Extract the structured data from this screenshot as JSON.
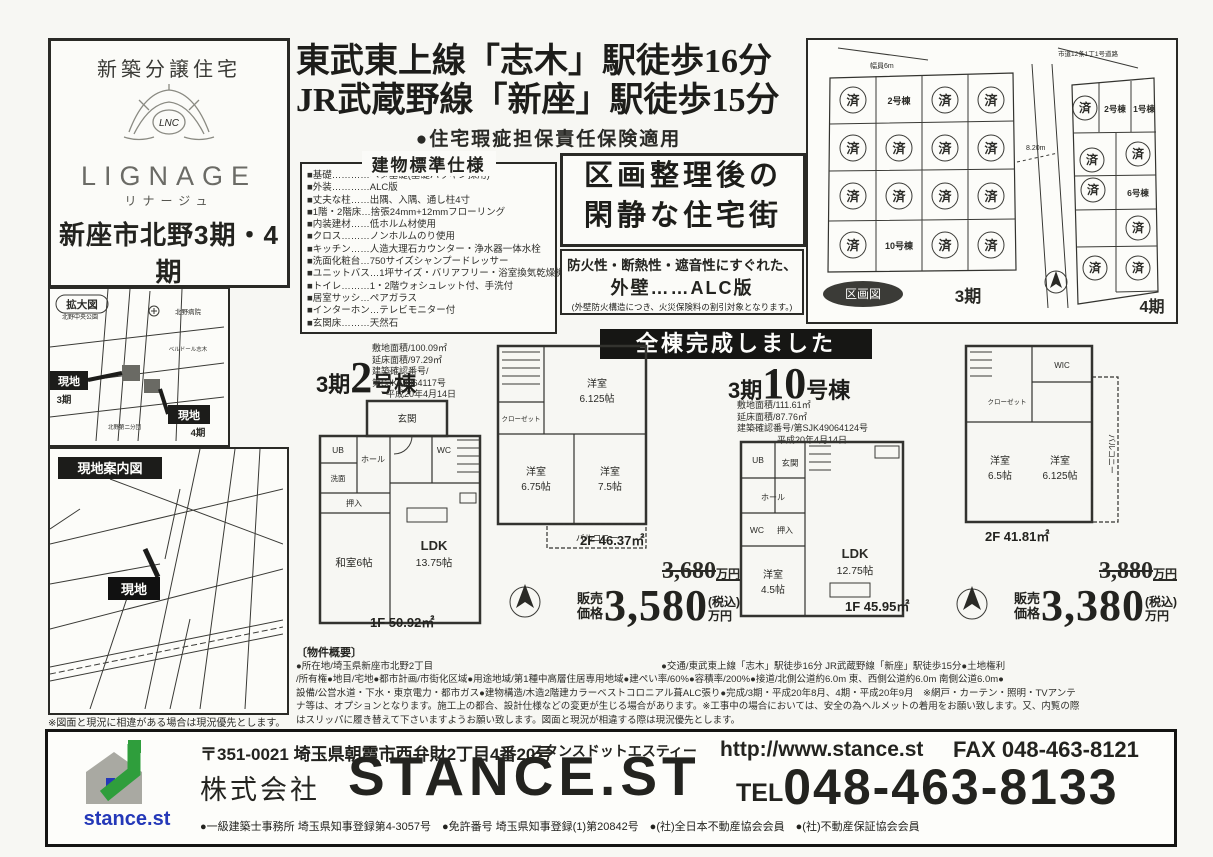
{
  "brand": {
    "tagline": "新築分譲住宅",
    "name": "LIGNAGE",
    "kana": "リナージュ",
    "project": "新座市北野3期・4期",
    "total_units": "全24棟"
  },
  "headline": {
    "line1": "東武東上線「志木」駅徒歩16分",
    "line2": "JR武蔵野線「新座」駅徒歩15分",
    "insurance": "●住宅瑕疵担保責任保険適用"
  },
  "specs": {
    "title": "建物標準仕様",
    "items": [
      "■基礎…………ベタ基礎(基礎パッキン採用)",
      "■外装…………ALC版",
      "■丈夫な柱……出隅、入隅、通し柱4寸",
      "■1階・2階床…捨張24mm+12mmフローリング",
      "■内装建材……低ホルム材使用",
      "■クロス………ノンホルムのり使用",
      "■キッチン……人造大理石カウンター・浄水器一体水栓",
      "■洗面化粧台…750サイズシャンプードレッサー",
      "■ユニットバス…1坪サイズ・バリアフリー・浴室換気乾燥機付",
      "■トイレ………1・2階ウォシュレット付、手洗付",
      "■居室サッシ…ペアガラス",
      "■インターホン…テレビモニター付",
      "■玄関床………天然石"
    ]
  },
  "quiet_box": {
    "line1": "区画整理後の",
    "line2": "閑静な住宅街"
  },
  "alc_box": {
    "line1": "防火性・断熱性・遮音性にすぐれた、",
    "line2": "外壁……ALC版",
    "note": "(外壁防火構造につき、火災保険料の割引対象となります。)"
  },
  "plot_map": {
    "label": "区画図",
    "road_top": "市道12条1丁1号道路",
    "width_label": "幅員6m",
    "dim_label": "8.20m",
    "phase3": "3期",
    "phase4": "4期",
    "sold": "済",
    "lot_p3_2": "2号棟",
    "lot_p3_10": "10号棟",
    "lot_p4_1": "1号棟",
    "lot_p4_2": "2号棟",
    "lot_p4_6": "6号棟"
  },
  "banner": "全棟完成しました",
  "units": [
    {
      "phase": "3期",
      "number": "2",
      "suffix": "号棟",
      "info": [
        "敷地面積/100.09㎡",
        "延床面積/97.29㎡",
        "建築確認番号/",
        "第SJK49064117号",
        "平成20年4月14日"
      ],
      "floor2_label": "2F 46.37㎡",
      "floor1_label": "1F 50.92㎡",
      "rooms_1f": [
        "玄関",
        "ホール",
        "UB",
        "洗面",
        "WC",
        "押入",
        "和室6帖",
        "LDK",
        "13.75帖"
      ],
      "rooms_2f": [
        "洋室",
        "6.125帖",
        "クローゼット",
        "洋室",
        "6.75帖",
        "洋室",
        "7.5帖",
        "バルコニー"
      ],
      "old_price": "3,680",
      "old_price_unit": "万円",
      "price_label1": "販売",
      "price_label2": "価格",
      "price": "3,580",
      "price_tax": "(税込)",
      "price_unit": "万円"
    },
    {
      "phase": "3期",
      "number": "10",
      "suffix": "号棟",
      "info": [
        "敷地面積/111.61㎡",
        "延床面積/87.76㎡",
        "建築確認番号/第SJK49064124号",
        "平成20年4月14日"
      ],
      "floor2_label": "2F 41.81㎡",
      "floor1_label": "1F 45.95㎡",
      "rooms_1f": [
        "UB",
        "玄関",
        "ホール",
        "WC",
        "押入",
        "洋室",
        "4.5帖",
        "LDK",
        "12.75帖"
      ],
      "rooms_2f": [
        "WIC",
        "クローゼット",
        "洋室",
        "6.5帖",
        "洋室",
        "6.125帖",
        "バルコニー"
      ],
      "old_price": "3,880",
      "old_price_unit": "万円",
      "price_label1": "販売",
      "price_label2": "価格",
      "price": "3,380",
      "price_tax": "(税込)",
      "price_unit": "万円"
    }
  ],
  "enlarged_map": {
    "label": "拡大図",
    "park": "北野中央公園",
    "hospital": "北野病院",
    "belle": "ベルドール志木",
    "fire_station": "北野第二分団",
    "site_label": "現地",
    "phase3": "3期",
    "phase4": "4期"
  },
  "guide_map": {
    "label": "現地案内図",
    "site_label": "現地",
    "note": "※図面と現況に相違がある場合は現況優先とします。"
  },
  "overview": {
    "title": "〔物件概要〕",
    "lines": [
      "●所在地/埼玉県新座市北野2丁目　　　　　　　　　　　　　　　　　　　　　　　　●交通/東武東上線「志木」駅徒歩16分 JR武蔵野線「新座」駅徒歩15分●土地権利",
      "/所有権●地目/宅地●都市計画/市街化区域●用途地域/第1種中高層住居専用地域●建ぺい率/60%●容積率/200%●接道/北側公道約6.0m 東、西側公道約6.0m 南側公道6.0m●",
      "設備/公営水道・下水・東京電力・都市ガス●建物構造/木造2階建カラーベストコロニアル葺ALC張り●完成/3期・平成20年8月、4期・平成20年9月　※網戸・カーテン・照明・TVアンテ",
      "ナ等は、オプションとなります。施工上の都合、設計仕様などの変更が生じる場合があります。※工事中の場合においては、安全の為ヘルメットの着用をお願い致します。又、内覧の際",
      "はスリッパに履き替えて下さいますようお願い致します。図面と現況が相違する際は現況優先とします。"
    ]
  },
  "footer": {
    "logo": "stance.st",
    "postal": "〒351-0021 埼玉県朝霞市西弁財2丁目4番20号",
    "kana": "スタンスドットエスティー",
    "company_prefix": "株式会社",
    "company": "STANCE.ST",
    "url": "http://www.stance.st",
    "fax": "FAX 048-463-8121",
    "tel_label": "TEL",
    "tel": "048-463-8133",
    "licenses": "●一級建築士事務所 埼玉県知事登録第4-3057号　●免許番号 埼玉県知事登録(1)第20842号　●(社)全日本不動産協会会員　●(社)不動産保証協会会員"
  }
}
